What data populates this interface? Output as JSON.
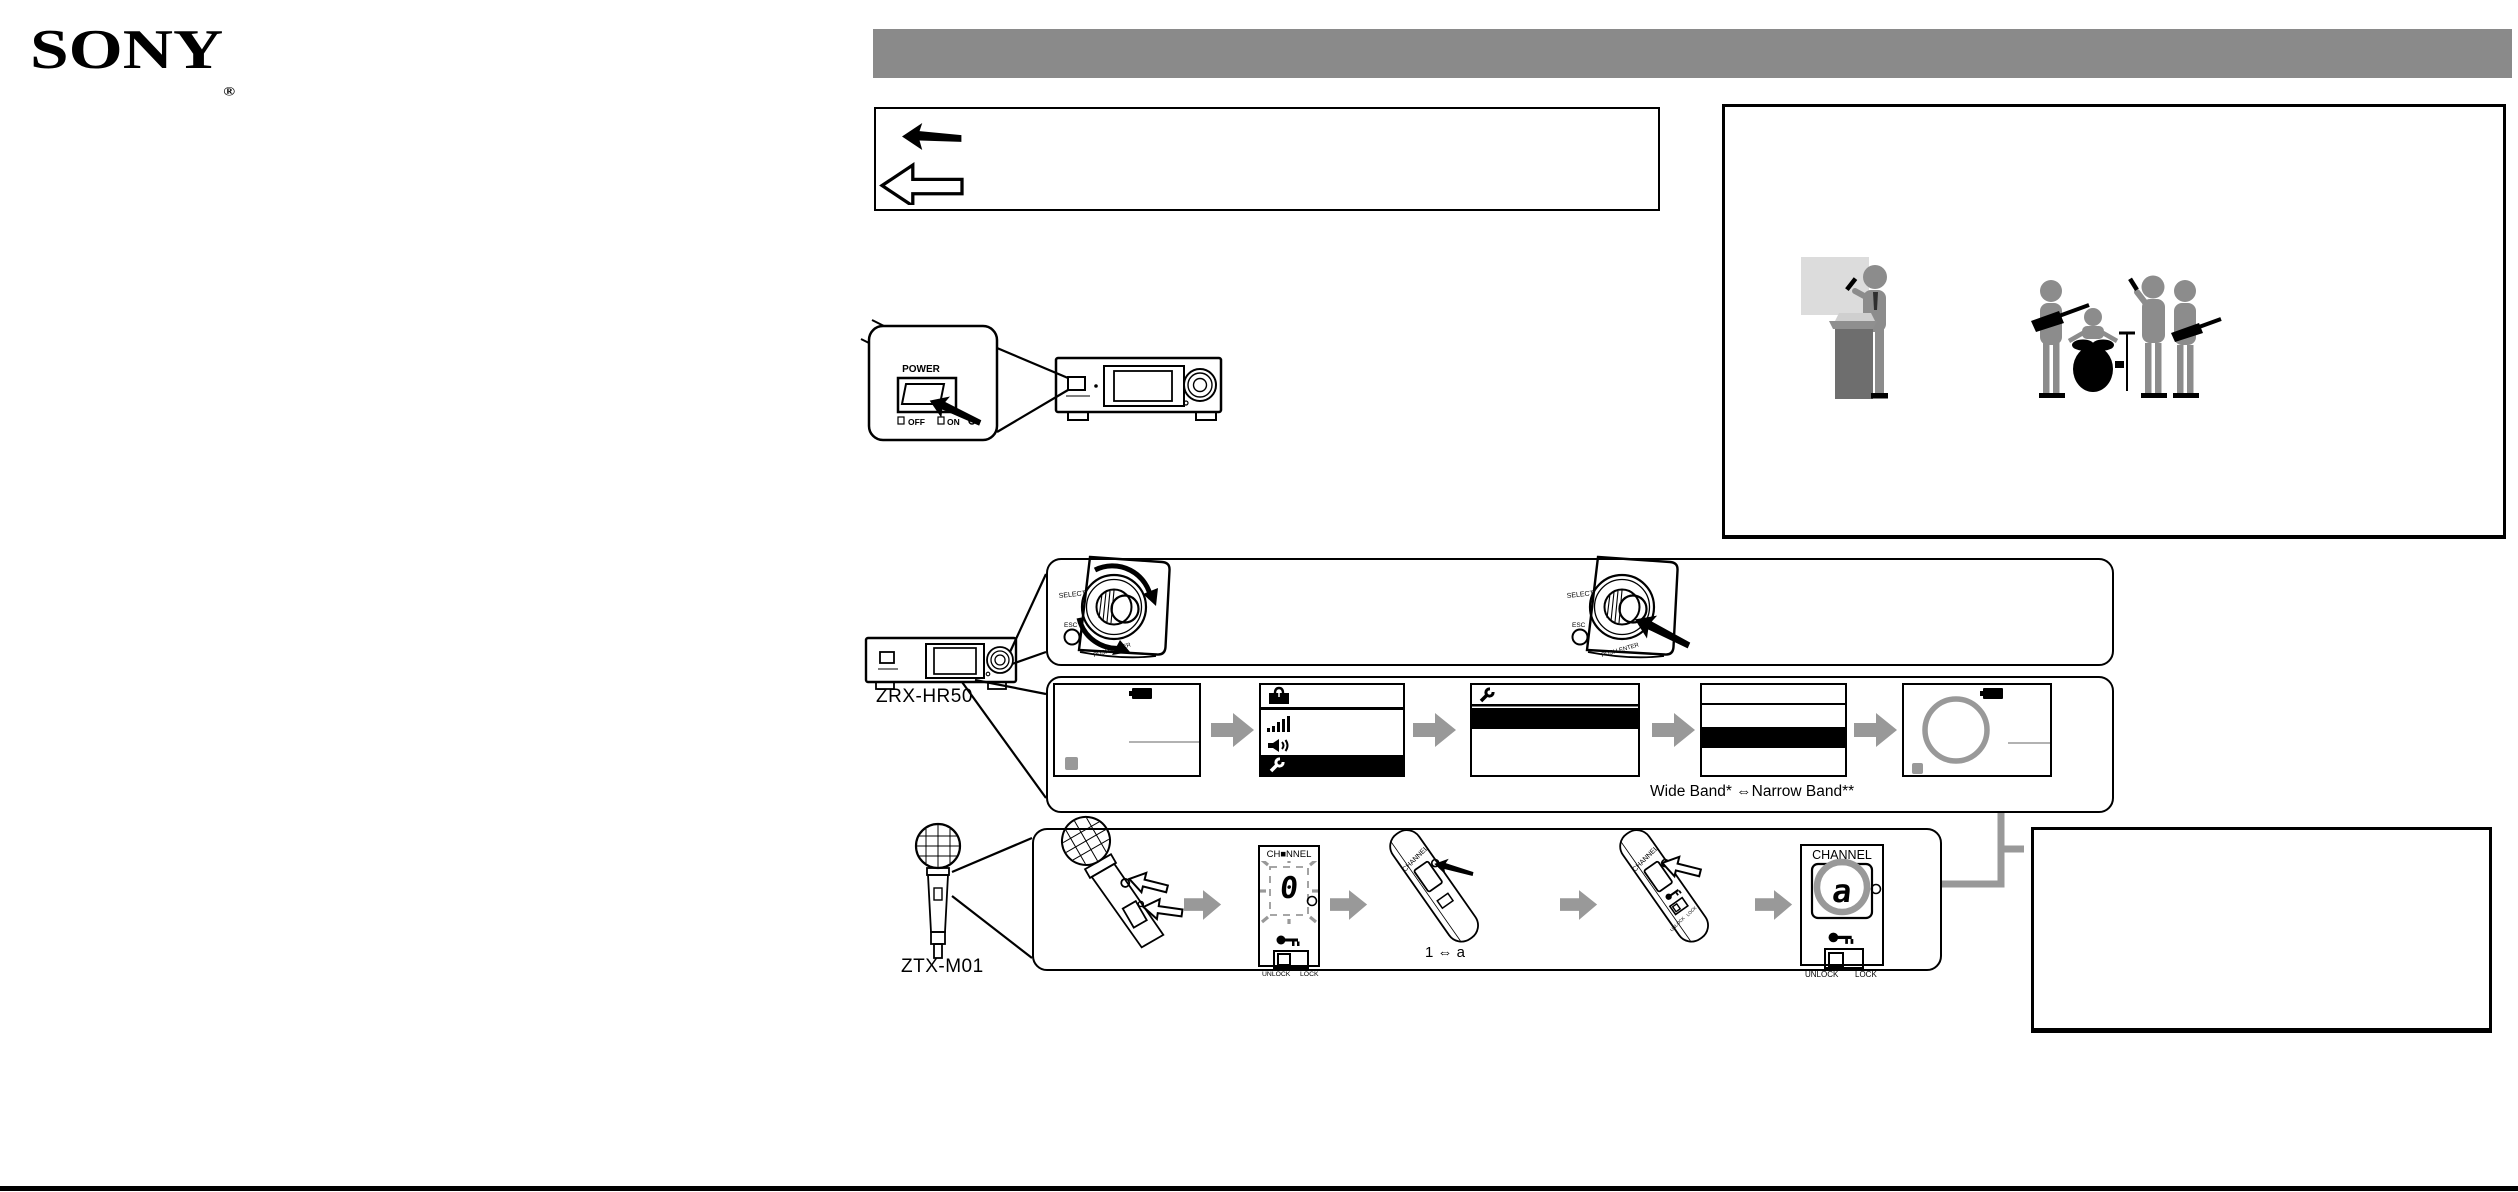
{
  "colors": {
    "banner_gray": "#8a8a8a",
    "flow_arrow_gray": "#999999",
    "connector_gray": "#999999",
    "figure_gray": "#8c8c8c",
    "podium_gray": "#6e6e6e",
    "screen_light_gray": "#dcdcdc",
    "lcd_black": "#000000"
  },
  "header": {
    "brand": "SONY",
    "registered_mark": "®"
  },
  "legend": {
    "icons": [
      "filled-left-arrow",
      "outline-left-arrow"
    ]
  },
  "power_section": {
    "power_label": "POWER",
    "off_label": "OFF",
    "on_label": "ON",
    "icons": [
      "power-switch",
      "press-arrow",
      "receiver-front"
    ]
  },
  "scene": {
    "figures": [
      "presenter-at-podium",
      "band-with-drums-and-guitars"
    ]
  },
  "receiver": {
    "model": "ZRX-HR50",
    "knob": {
      "select_label": "SELECT",
      "esc_label": "ESC",
      "push_label": "PUSH ENTER"
    }
  },
  "transmitter": {
    "model": "ZTX-M01"
  },
  "lcd_flow": {
    "band_note": "Wide Band* ⇔Narrow Band**",
    "screens": [
      {
        "name": "status-screen",
        "icons": [
          "battery"
        ]
      },
      {
        "name": "menu-screen",
        "icons": [
          "toolbox",
          "signal-strength",
          "speaker",
          "wrench"
        ]
      },
      {
        "name": "settings-screen",
        "icons": [
          "wrench"
        ]
      },
      {
        "name": "band-select-screen",
        "icons": []
      },
      {
        "name": "channel-status-screen",
        "icons": [
          "battery",
          "highlight-circle"
        ]
      }
    ]
  },
  "mic_flow": {
    "display_flashing": {
      "title": "CH■NNEL",
      "digit": "0",
      "unlock_label": "UNLOCK",
      "lock_label": "LOCK"
    },
    "channel_label": "CHANNEL",
    "toggle_note": "1 ⇔ a",
    "display_final": {
      "title": "CHANNEL",
      "digit": "a",
      "unlock_label": "UNLOCK",
      "lock_label": "LOCK"
    }
  }
}
